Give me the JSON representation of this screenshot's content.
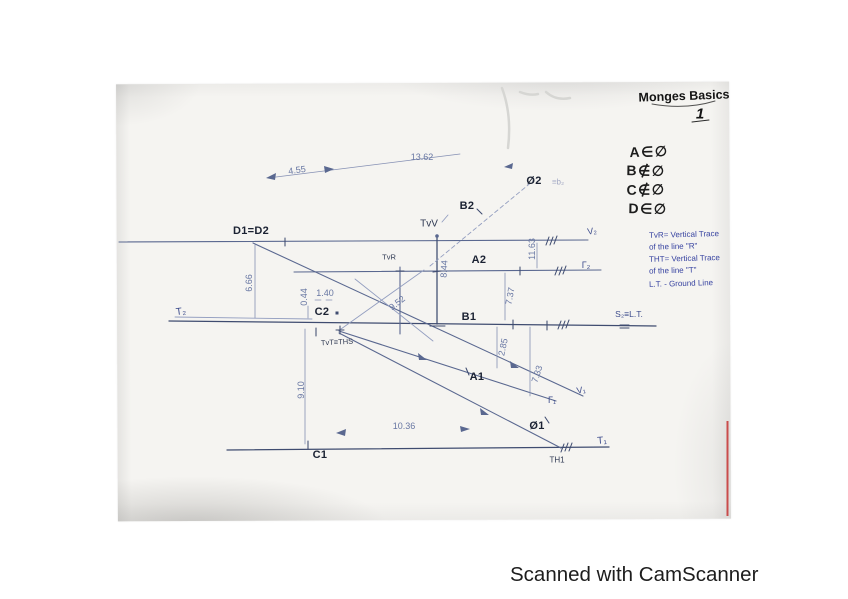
{
  "page": {
    "title": {
      "main": "Monges Basics",
      "number": "1"
    },
    "membership": [
      "A∈∅",
      "B∉∅",
      "C∉∅",
      "D∈∅"
    ],
    "legend": [
      "TvR= Vertical Trace",
      "of the line \"R\"",
      "THT= Vertical Trace",
      "of the line \"T\"",
      "L.T. - Ground Line"
    ],
    "drawing": {
      "labels": {
        "d1d2": "D1=D2",
        "a2": "A2",
        "b2": "B2",
        "b1": "B1",
        "a1": "A1",
        "c1": "C1",
        "c2": "C2",
        "phi2": "Ø2",
        "phi2_suffix": "≡b₂",
        "phi1": "Ø1",
        "tvv": "TvV",
        "tvr": "TvR",
        "tvt": "TvT≡THS",
        "th1": "TH1",
        "t1": "T₁",
        "t2": "T₂",
        "v1": "V₁",
        "v2": "V₂",
        "g1": "Γ₁",
        "g2": "Γ₂",
        "s2": "S₂≡L.T."
      },
      "dimensions": {
        "d13_62": "13.62",
        "d4_55": "4.55",
        "d11_63": "11.63",
        "d6_66": "6.66",
        "d0_44": "0.44",
        "d1_40": "1.40",
        "d9_52": "9.52",
        "d8_44": "8.44",
        "d7_37": "7.37",
        "d2_85": "2.85",
        "d7_33": "7.33",
        "d9_10": "9.10",
        "d10_36": "10.36"
      }
    },
    "watermark": "Scanned with CamScanner",
    "colors": {
      "ink": "#1c2233",
      "blue_ink": "#3d4c8c",
      "pencil": "#6877a3",
      "paper": "#f5f4f1",
      "red_edge": "#c63333"
    }
  }
}
